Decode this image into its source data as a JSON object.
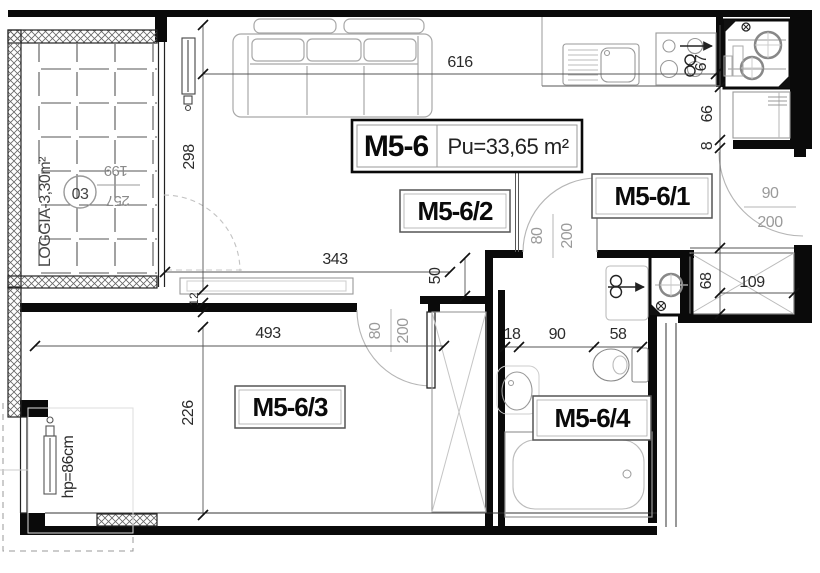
{
  "title": {
    "unit": "M5-6",
    "area": "Pu=33,65 m²"
  },
  "rooms": {
    "r1": "M5-6/1",
    "r2": "M5-6/2",
    "r3": "M5-6/3",
    "r4": "M5-6/4"
  },
  "loggia": {
    "label": "LOGGIA-3,30m²",
    "number": "03",
    "dim_w": "199",
    "dim_h": "257"
  },
  "dims": {
    "top": "616",
    "living_height": "298",
    "living_width": "343",
    "nook": "50",
    "wall_thk": "12",
    "bedroom_w": "493",
    "bedroom_h": "226",
    "bath_left": "18",
    "bath_door": "90",
    "bath_right": "58",
    "stove": "67",
    "right1": "66",
    "right2": "8",
    "right3": "107",
    "entry_h": "68",
    "entry_w": "109",
    "parapet": "hp=86cm"
  },
  "doors": {
    "bedroom_w": "80",
    "bedroom_h": "200",
    "bath_w": "80",
    "bath_h": "200",
    "entry_w": "90",
    "entry_h": "200"
  }
}
